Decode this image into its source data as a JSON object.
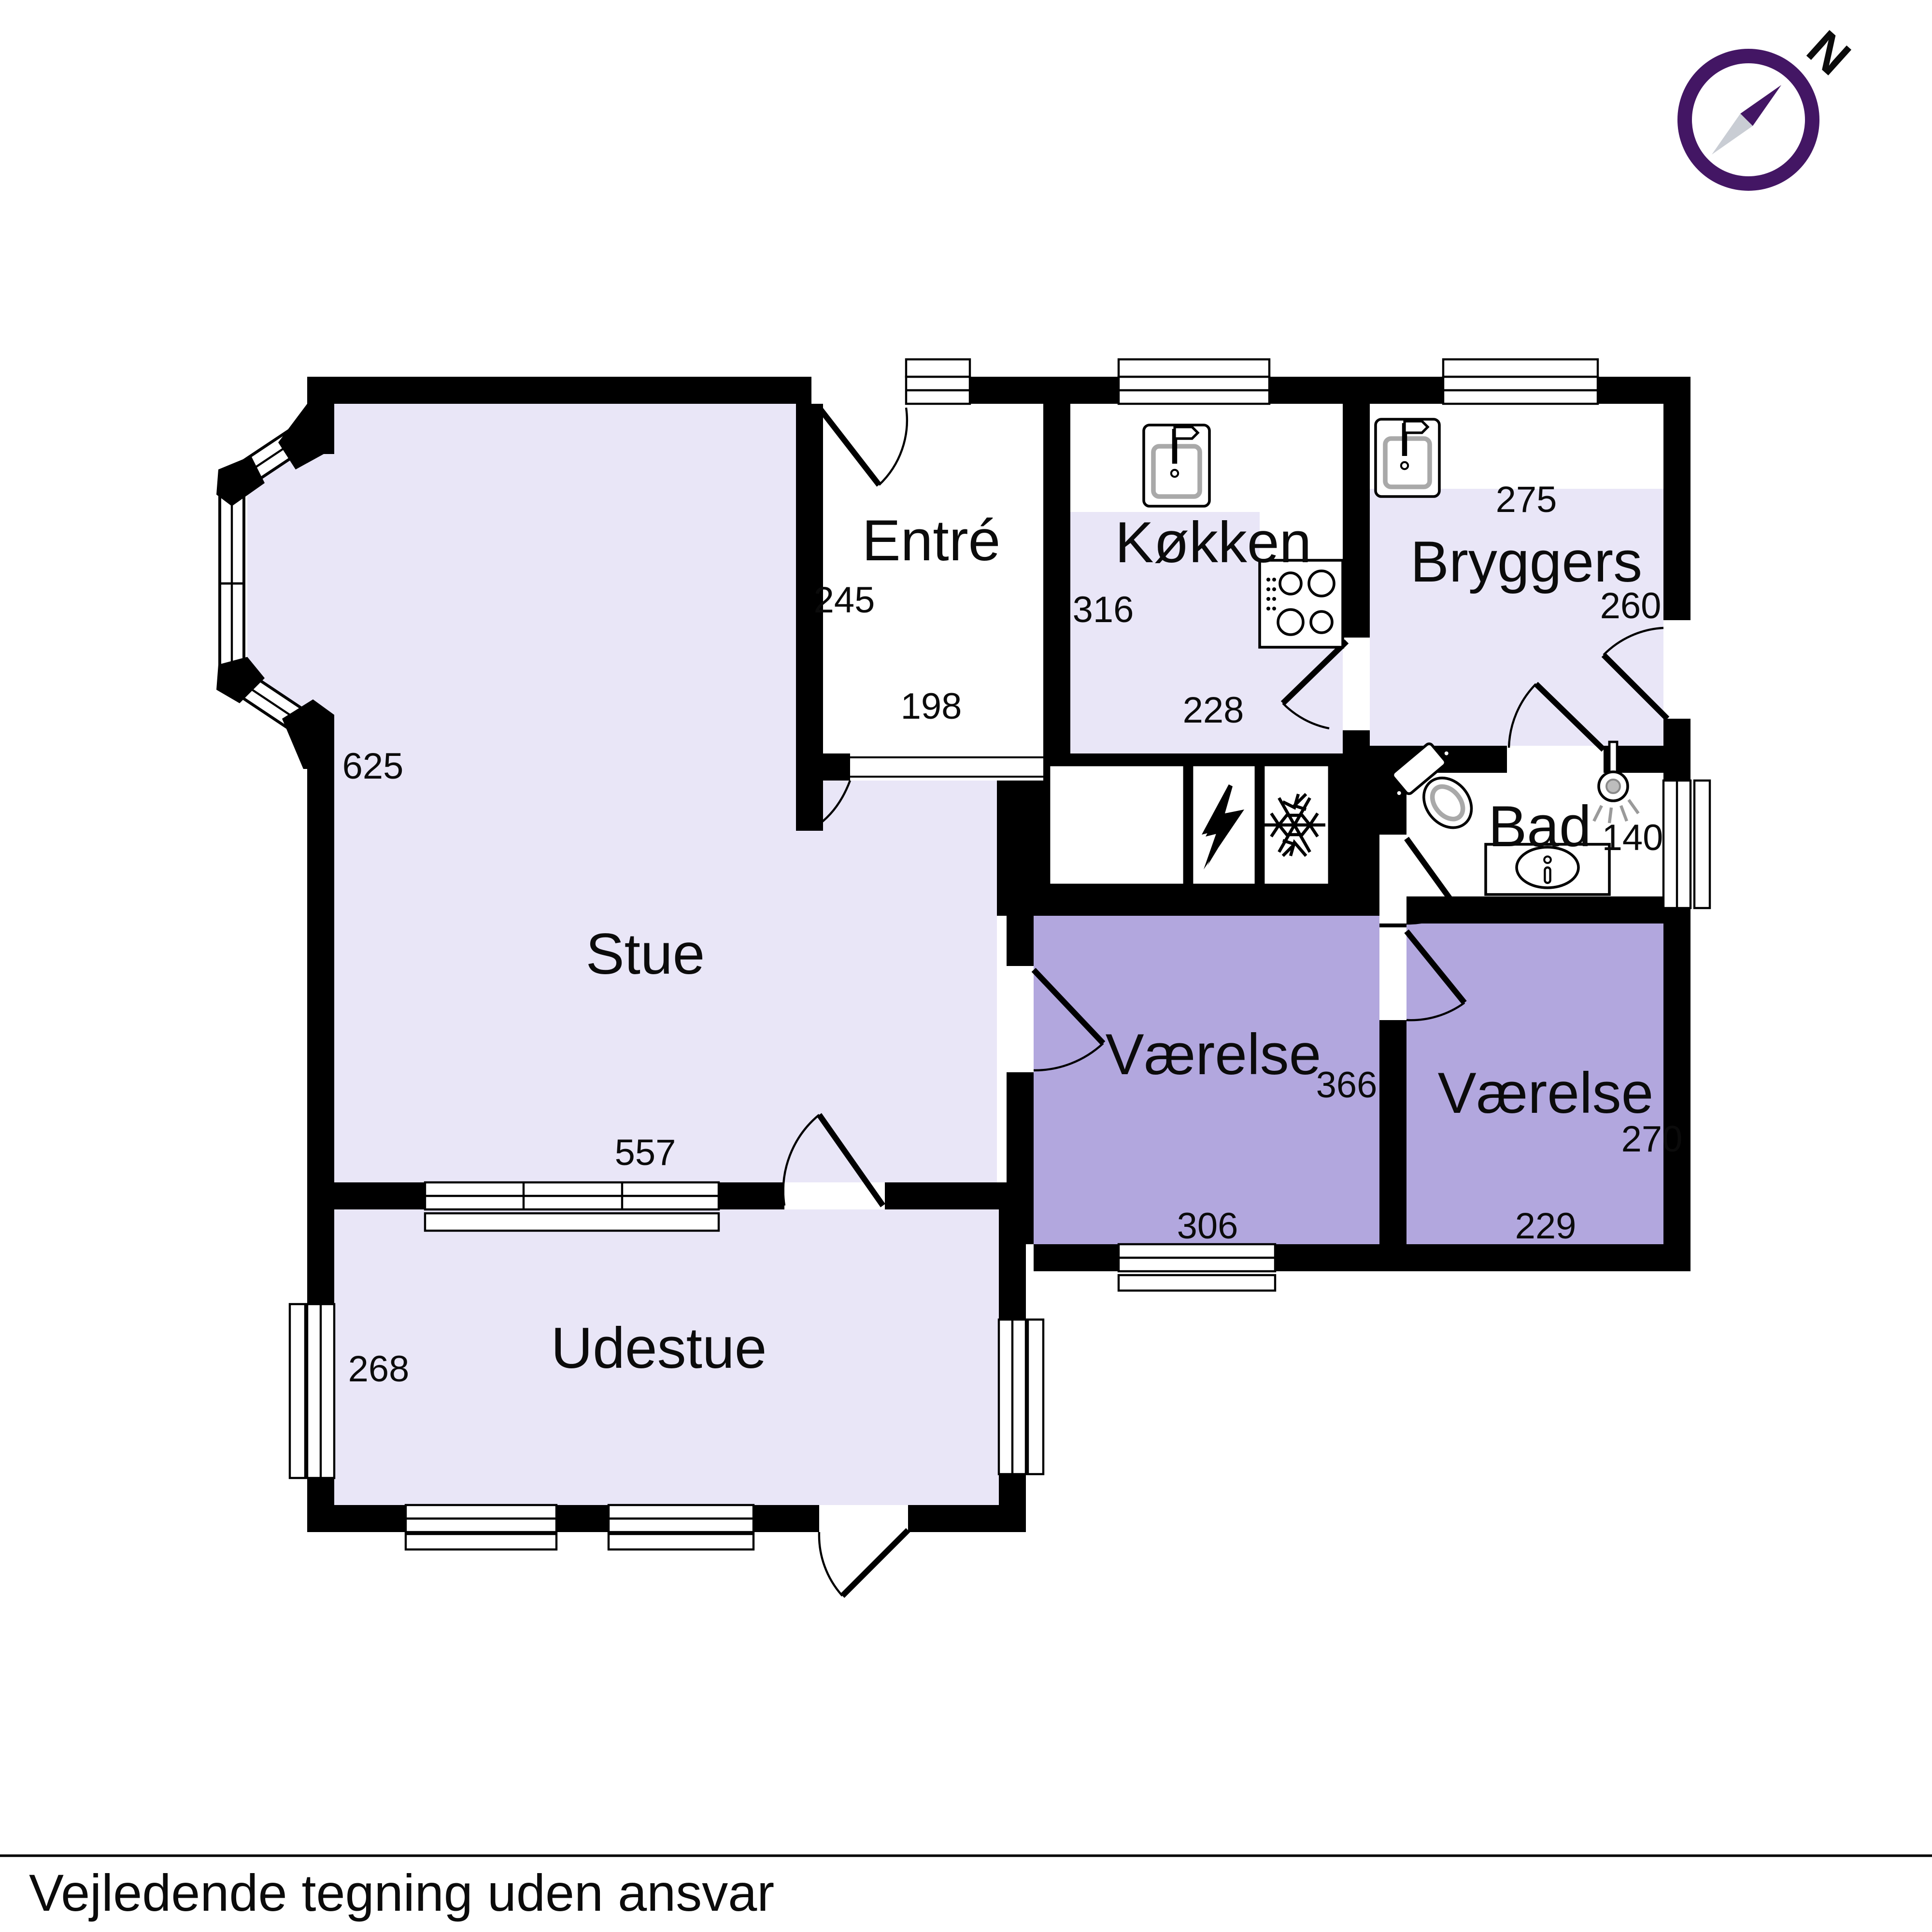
{
  "footer": {
    "note": "Vejledende tegning uden ansvar"
  },
  "compass": {
    "label": "N"
  },
  "colors": {
    "floor_light": "#e9e6f7",
    "floor_accent": "#b2a7de",
    "wall": "#000000",
    "compass_purple": "#431664",
    "needle_gray": "#c9cdd4"
  },
  "rooms": {
    "stue": {
      "label": "Stue",
      "width_cm": "557",
      "height_cm": "625"
    },
    "entre": {
      "label": "Entré",
      "width_cm": "198",
      "height_cm": "245"
    },
    "kokken": {
      "label": "Køkken",
      "width_cm": "228",
      "height_cm": "316"
    },
    "bryggers": {
      "label": "Bryggers",
      "width_cm": "275",
      "height_cm": "260"
    },
    "bad": {
      "label": "Bad",
      "width_cm": "140"
    },
    "vaerelse1": {
      "label": "Værelse",
      "width_cm": "306",
      "height_cm": "366"
    },
    "vaerelse2": {
      "label": "Værelse",
      "width_cm": "229",
      "height_cm": "270"
    },
    "udestue": {
      "label": "Udestue",
      "height_cm": "268"
    }
  },
  "fixtures": {
    "kitchen_sink": "sink-icon",
    "utility_sink": "sink-icon",
    "stove": "stove-icon",
    "electrical": "lightning-icon",
    "freezer": "snowflake-icon",
    "toilet": "toilet-icon",
    "shower": "shower-icon",
    "vanity_sink": "vanity-sink-icon"
  }
}
